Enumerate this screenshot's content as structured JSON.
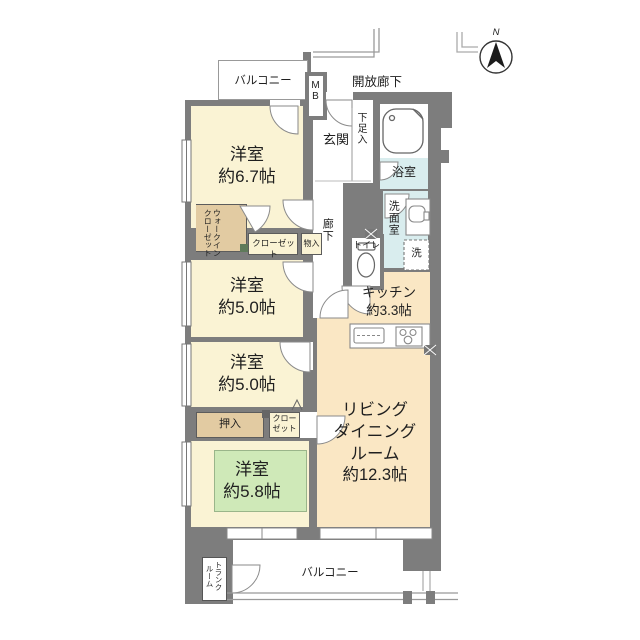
{
  "plan": {
    "compass": {
      "label": "N"
    },
    "balcony_top": {
      "label": "バルコニー"
    },
    "open_corridor": {
      "label": "開放廊下"
    },
    "meter_box": {
      "label": "MB"
    },
    "entrance": {
      "label": "玄関"
    },
    "shoe_box": {
      "label": "下足入"
    },
    "bathroom": {
      "label": "浴室"
    },
    "washroom": {
      "label": "洗面室"
    },
    "washer": {
      "label": "洗"
    },
    "hallway": {
      "label": "廊下"
    },
    "toilet": {
      "label": "トイレ"
    },
    "walk_in_closet": {
      "label": "ウォークイン\nクローゼット"
    },
    "closet_top": {
      "label": "クローゼット"
    },
    "storage": {
      "label": "物入"
    },
    "bedroom1": {
      "label": "洋室\n約6.7帖"
    },
    "bedroom2": {
      "label": "洋室\n約5.0帖"
    },
    "bedroom3": {
      "label": "洋室\n約5.0帖"
    },
    "bedroom4": {
      "label": "洋室\n約5.8帖"
    },
    "kitchen": {
      "label": "キッチン\n約3.3帖"
    },
    "living_dining": {
      "label": "リビング\nダイニング\nルーム\n約12.3帖"
    },
    "oshiire": {
      "label": "押入"
    },
    "closet_bottom": {
      "label": "クロー\nゼット"
    },
    "balcony_bottom": {
      "label": "バルコニー"
    },
    "trunk_room": {
      "label": "トランク\nルーム"
    },
    "colors": {
      "wall": "#7d7d7d",
      "room_cream": "#faf3d4",
      "ldk_peach": "#fae7c4",
      "bedroom_green": "#cfe9b8",
      "closet_tan": "#e2cba2",
      "bath_blue": "#d9edee"
    }
  }
}
